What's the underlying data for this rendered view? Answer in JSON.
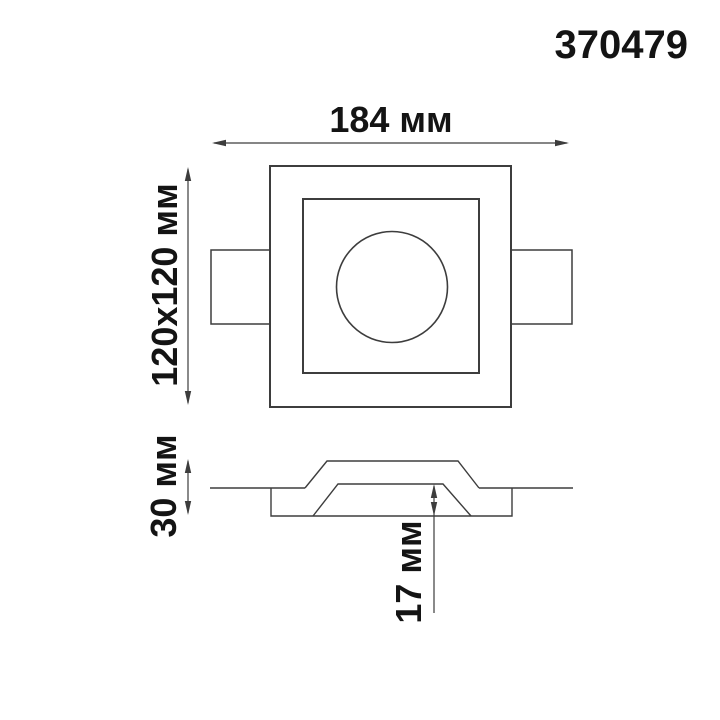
{
  "product": {
    "article": "370479"
  },
  "top_view": {
    "width_label": "184 мм",
    "face_label": "120x120 мм"
  },
  "section_view": {
    "height_label": "30 мм",
    "depth_label": "17 мм"
  },
  "colors": {
    "line": "#3d3d3d",
    "text": "#141414",
    "background": "#ffffff"
  }
}
